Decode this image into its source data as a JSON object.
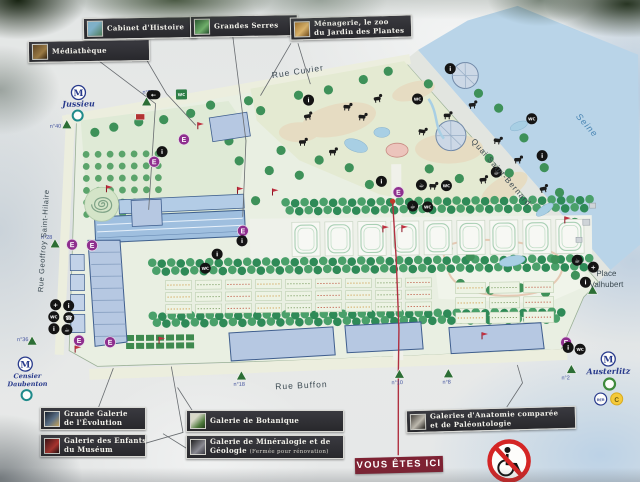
{
  "panel": {
    "legend_top": {
      "mediatheque": "Médiathèque",
      "cabinet": "Cabinet d'Histoire",
      "serres": "Grandes Serres",
      "menagerie_l1": "Ménagerie, le zoo",
      "menagerie_l2": "du Jardin des Plantes"
    },
    "legend_bottom": {
      "evolution_l1": "Grande Galerie",
      "evolution_l2": "de l'Évolution",
      "enfants_l1": "Galerie des Enfants",
      "enfants_l2": "du Muséum",
      "botanique": "Galerie de Botanique",
      "mineralogie_l1": "Galerie de Minéralogie et de",
      "mineralogie_l2": "Géologie",
      "mineralogie_note": "(Fermée pour rénovation)",
      "anatomie_l1": "Galeries d'Anatomie comparée",
      "anatomie_l2": "et de Paléontologie"
    },
    "you_are_here": "VOUS ÊTES ICI"
  },
  "streets": {
    "rue_cuvier": "Rue Cuvier",
    "quai": "Quai Saint-Bernard",
    "seine": "Seine",
    "rue_gsh": "Rue Geoffroy Saint-Hilaire",
    "rue_buffon": "Rue Buffon",
    "place_l1": "Place",
    "place_l2": "Valhubert"
  },
  "transit": {
    "metro_letter": "M",
    "jussieu": "Jussieu",
    "censier_l1": "Censier",
    "censier_l2": "Daubenton",
    "austerlitz": "Austerlitz",
    "rer": "RER",
    "line_c": "C"
  },
  "icons": {
    "entrance": "E",
    "info": "i",
    "first_aid": "+",
    "toilets": "WC",
    "cafe": "☕",
    "phone": "☎",
    "direction": "←"
  },
  "map_markers": {
    "entrance_triangles": [
      {
        "x": 68,
        "y": 122,
        "label": "n°40",
        "lx": -17,
        "ly": 3
      },
      {
        "x": 148,
        "y": 100,
        "label": "n°57",
        "lx": -4,
        "ly": -8
      },
      {
        "x": 55,
        "y": 241,
        "label": "n°28",
        "lx": -14,
        "ly": -5
      },
      {
        "x": 31,
        "y": 338,
        "label": "n°36",
        "lx": -15,
        "ly": 0
      },
      {
        "x": 240,
        "y": 375,
        "label": "n°18",
        "lx": -8,
        "ly": 10
      },
      {
        "x": 398,
        "y": 375,
        "label": "n°10",
        "lx": -8,
        "ly": 10
      },
      {
        "x": 447,
        "y": 375,
        "label": "n°8",
        "lx": -6,
        "ly": 10
      },
      {
        "x": 592,
        "y": 293,
        "label": "",
        "lx": 0,
        "ly": 0
      },
      {
        "x": 570,
        "y": 372,
        "label": "n°2",
        "lx": -10,
        "ly": 10
      }
    ],
    "entrance_circles": [
      [
        72,
        242
      ],
      [
        92,
        243
      ],
      [
        185,
        138
      ],
      [
        155,
        160
      ],
      [
        243,
        230
      ],
      [
        399,
        193
      ],
      [
        78,
        338
      ],
      [
        109,
        340
      ],
      [
        565,
        345
      ]
    ],
    "black_icons": [
      {
        "n": "direction-icon",
        "g": "direction",
        "x": 155,
        "y": 93,
        "pill": true
      },
      {
        "n": "toilets-icon",
        "g": "toilets",
        "x": 183,
        "y": 93,
        "sq": true
      },
      {
        "n": "info-icon",
        "g": "info",
        "x": 163,
        "y": 150
      },
      {
        "n": "info-icon",
        "g": "info",
        "x": 310,
        "y": 100
      },
      {
        "n": "toilets-icon",
        "g": "toilets",
        "x": 419,
        "y": 100
      },
      {
        "n": "info-icon",
        "g": "info",
        "x": 452,
        "y": 70
      },
      {
        "n": "toilets-icon",
        "g": "toilets",
        "x": 533,
        "y": 121
      },
      {
        "n": "info-icon",
        "g": "info",
        "x": 543,
        "y": 158
      },
      {
        "n": "cafe-icon",
        "g": "cafe",
        "x": 497,
        "y": 174
      },
      {
        "n": "cafe-icon",
        "g": "cafe",
        "x": 422,
        "y": 186
      },
      {
        "n": "toilets-icon",
        "g": "toilets",
        "x": 447,
        "y": 187
      },
      {
        "n": "info-icon",
        "g": "info",
        "x": 382,
        "y": 182
      },
      {
        "n": "cafe-icon",
        "g": "cafe",
        "x": 413,
        "y": 207
      },
      {
        "n": "toilets-icon",
        "g": "toilets",
        "x": 428,
        "y": 208
      },
      {
        "n": "info-icon",
        "g": "info",
        "x": 217,
        "y": 253
      },
      {
        "n": "toilets-icon",
        "g": "toilets",
        "x": 205,
        "y": 267
      },
      {
        "n": "info-icon",
        "g": "info",
        "x": 242,
        "y": 240
      },
      {
        "n": "first-aid-icon",
        "g": "first_aid",
        "x": 55,
        "y": 302
      },
      {
        "n": "info-icon",
        "g": "info",
        "x": 68,
        "y": 303
      },
      {
        "n": "toilets-icon",
        "g": "toilets",
        "x": 53,
        "y": 314
      },
      {
        "n": "phone-icon",
        "g": "phone",
        "x": 68,
        "y": 315
      },
      {
        "n": "info-icon",
        "g": "info",
        "x": 53,
        "y": 326
      },
      {
        "n": "cafe-icon",
        "g": "cafe",
        "x": 66,
        "y": 327
      },
      {
        "n": "cafe-icon",
        "g": "cafe",
        "x": 577,
        "y": 263
      },
      {
        "n": "first-aid-icon",
        "g": "first_aid",
        "x": 593,
        "y": 270
      },
      {
        "n": "info-icon",
        "g": "info",
        "x": 585,
        "y": 285
      },
      {
        "n": "info-icon",
        "g": "info",
        "x": 567,
        "y": 350
      },
      {
        "n": "toilets-icon",
        "g": "toilets",
        "x": 579,
        "y": 352
      }
    ],
    "red_flags": [
      [
        199,
        128
      ],
      [
        238,
        193
      ],
      [
        273,
        195
      ],
      [
        107,
        190
      ],
      [
        383,
        233
      ],
      [
        402,
        233
      ],
      [
        565,
        226
      ],
      [
        74,
        350
      ],
      [
        158,
        342
      ],
      [
        481,
        341
      ]
    ]
  },
  "colors": {
    "accent_red": "#7e2233",
    "legend_bg": "#2e2e32",
    "building": "#b6c8e2",
    "water": "#b9d4e8",
    "tree": "#2f8f5d",
    "entrance_purple": "#8e2f8e",
    "triangle_green": "#2c6e35",
    "metro_blue": "#283a8c",
    "red_line": "#b03040"
  }
}
